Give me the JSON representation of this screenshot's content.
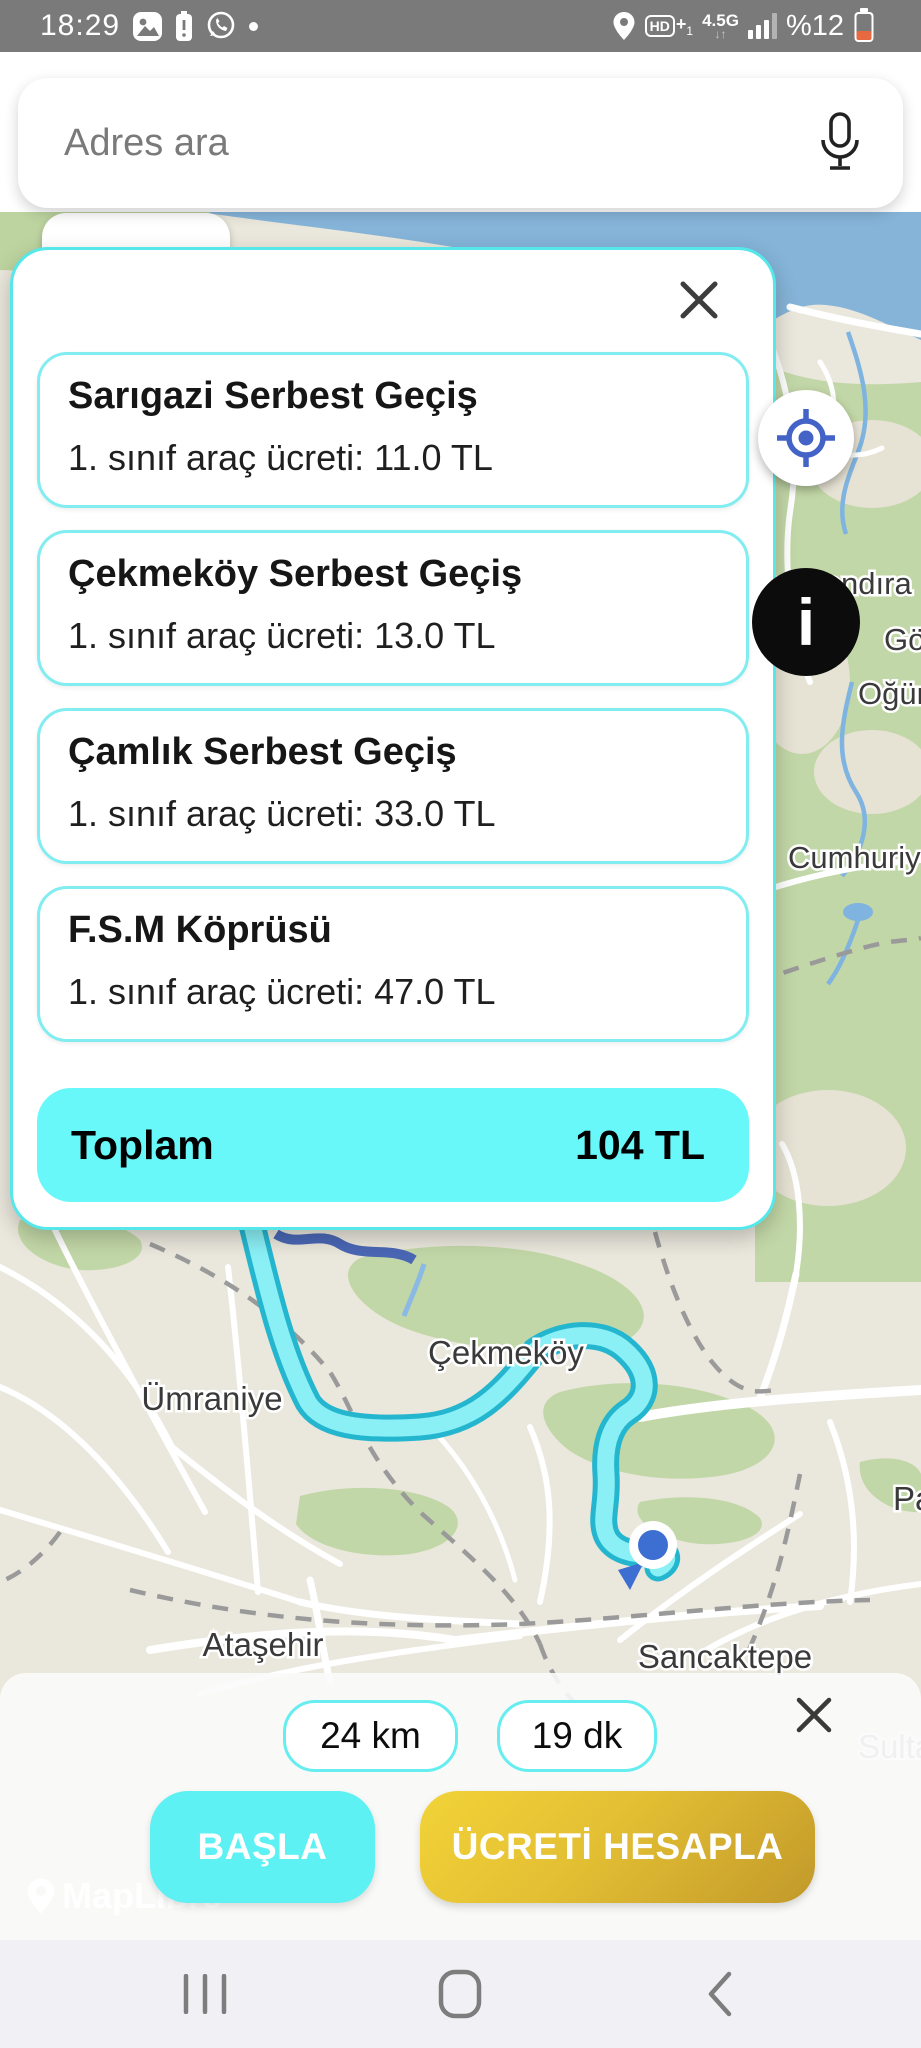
{
  "status_bar": {
    "time": "18:29",
    "battery_percent": "%12",
    "network": "4.5G",
    "net_arrows": "↓↑",
    "hd_label": "HD",
    "hd_plus": "+",
    "hd_sub": "1"
  },
  "search": {
    "placeholder": "Adres ara"
  },
  "toll_modal": {
    "items": [
      {
        "title": "Sarıgazi Serbest Geçiş",
        "fee": "1. sınıf araç ücreti: 11.0 TL"
      },
      {
        "title": "Çekmeköy Serbest Geçiş",
        "fee": "1. sınıf araç ücreti: 13.0 TL"
      },
      {
        "title": "Çamlık Serbest Geçiş",
        "fee": "1. sınıf araç ücreti: 33.0 TL"
      },
      {
        "title": "F.S.M Köprüsü",
        "fee": "1. sınıf araç ücreti: 47.0 TL"
      }
    ],
    "total_label": "Toplam",
    "total_value": "104 TL"
  },
  "map": {
    "labels": [
      {
        "text": "aşamandıra"
      },
      {
        "text": "Göl"
      },
      {
        "text": "Oğüm"
      },
      {
        "text": "Cumhuriy"
      },
      {
        "text": "Çekmeköy"
      },
      {
        "text": "Ümraniye"
      },
      {
        "text": "Ataşehir"
      },
      {
        "text": "Sancaktepe"
      },
      {
        "text": "Pa"
      },
      {
        "text": "Sultanb"
      }
    ],
    "watermark": "MapLibre"
  },
  "controls": {
    "info_glyph": "i"
  },
  "bottom_sheet": {
    "distance": "24 km",
    "duration": "19 dk",
    "start_button": "BAŞLA",
    "calculate_button": "ÜCRETİ HESAPLA"
  },
  "colors": {
    "accent_cyan": "#5ee9ec",
    "total_bg": "#69f8fa",
    "route_fill": "#8af0f6",
    "route_border": "#25b6cf",
    "gold_start": "#f2d338",
    "gold_end": "#c2992a",
    "water": "#85b4d8",
    "low_battery": "#e8693f"
  }
}
